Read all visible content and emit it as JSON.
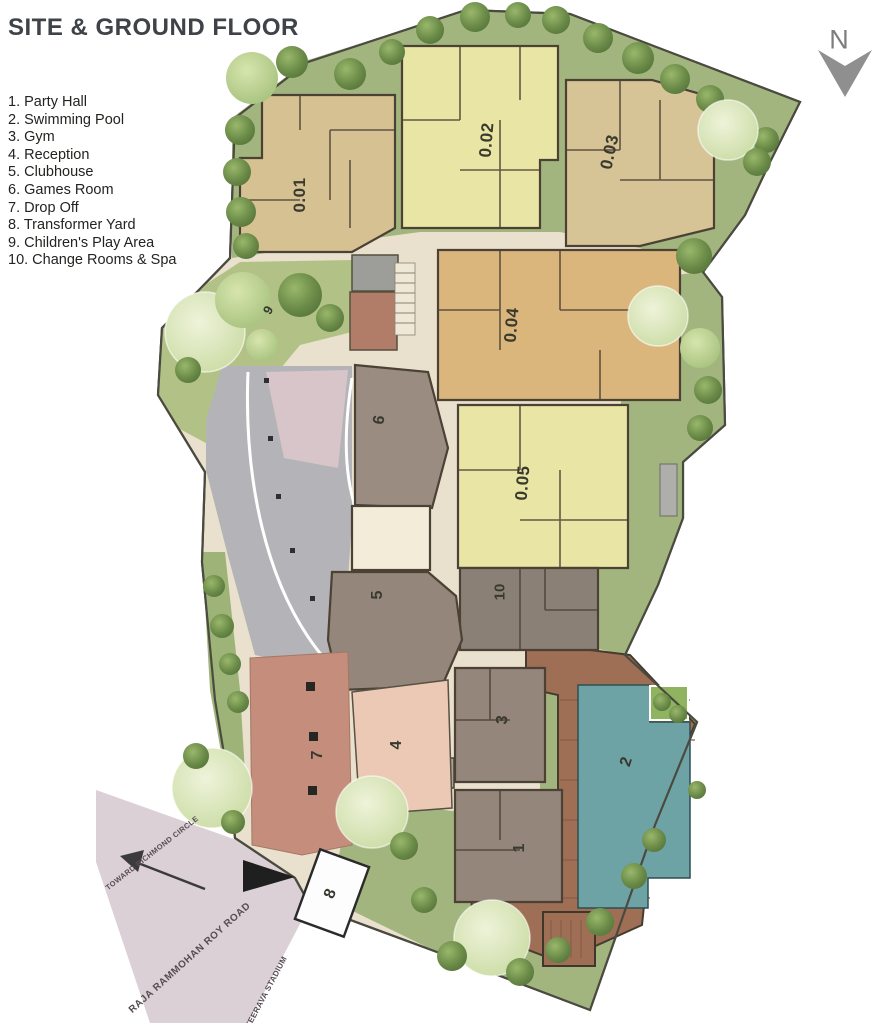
{
  "title": "SITE & GROUND FLOOR",
  "legend": {
    "items": [
      "1. Party Hall",
      "2. Swimming Pool",
      "3. Gym",
      "4. Reception",
      "5. Clubhouse",
      "6. Games Room",
      "7. Drop Off",
      "8. Transformer Yard",
      "9. Children's Play Area",
      "10. Change Rooms & Spa"
    ]
  },
  "compass": {
    "label": "N"
  },
  "plan": {
    "unit_labels": [
      "0.01",
      "0.02",
      "0.03",
      "0.04",
      "0.05"
    ],
    "area_labels": [
      "1",
      "2",
      "3",
      "4",
      "5",
      "6",
      "7",
      "8",
      "9",
      "10"
    ],
    "road": {
      "name": "RAJA RAMMOHAN ROY ROAD",
      "direction_left": "TOWARD RICHMOND CIRCLE",
      "direction_right": "KANTEERAVA STADIUM"
    },
    "colors": {
      "site_green": "#a3b57e",
      "lawn_light": "#c3d49c",
      "path_beige": "#e9e1cd",
      "building_tan": "#d6c193",
      "building_yellow": "#e9e5a4",
      "building_orange": "#dbb67c",
      "building_taupe": "#94867a",
      "pool_teal": "#6ea3a6",
      "deck_brown": "#9e6e55",
      "brick_red": "#c48d7c",
      "reception_pink": "#ecc9b4",
      "driveway_gray": "#b4b3b7",
      "road_gray": "#dbd0d5"
    }
  }
}
